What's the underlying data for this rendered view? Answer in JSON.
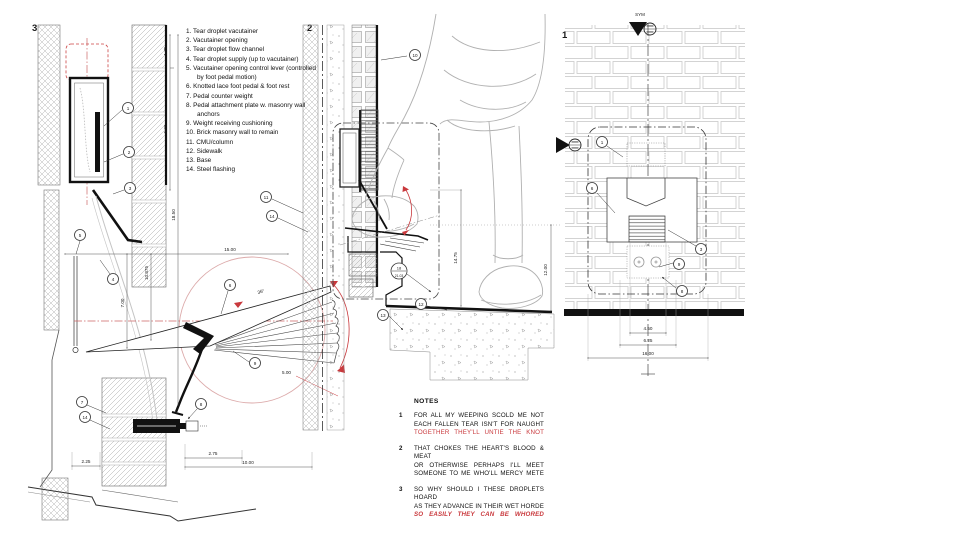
{
  "labels": {
    "detail3": "3",
    "detail2": "2",
    "detail1": "1",
    "sym": "SYM"
  },
  "legend": {
    "items": [
      {
        "num": "1.",
        "text": "Tear droplet vacutainer"
      },
      {
        "num": "2.",
        "text": "Vacutainer opening"
      },
      {
        "num": "3.",
        "text": "Tear droplet flow channel"
      },
      {
        "num": "4.",
        "text": "Tear droplet supply (up to vacutainer)"
      },
      {
        "num": "5.",
        "text": "Vacutainer opening control lever (controlled by foot pedal motion)"
      },
      {
        "num": "6.",
        "text": "Knotted lace foot pedal & foot rest"
      },
      {
        "num": "7.",
        "text": "Pedal counter weight"
      },
      {
        "num": "8.",
        "text": "Pedal attachment plate w. masonry wall anchors"
      },
      {
        "num": "9.",
        "text": "Weight receiving cushioning"
      },
      {
        "num": "10.",
        "text": "Brick masonry wall to remain"
      },
      {
        "num": "11.",
        "text": "CMU/column"
      },
      {
        "num": "12.",
        "text": "Sidewalk"
      },
      {
        "num": "13.",
        "text": "Base"
      },
      {
        "num": "14.",
        "text": "Steel flashing"
      }
    ]
  },
  "notes": {
    "title": "NOTES",
    "items": [
      {
        "num": "1",
        "lines": [
          "FOR ALL MY WEEPING SCOLD ME NOT",
          "EACH FALLEN TEAR ISN'T FOR NAUGHT",
          "TOGETHER THEY'LL UNTIE THE KNOT"
        ]
      },
      {
        "num": "2",
        "lines": [
          "THAT CHOKES THE HEART'S BLOOD & MEAT",
          "OR OTHERWISE PERHAPS I'LL MEET",
          "SOMEONE TO ME WHO'LL MERCY METE"
        ]
      },
      {
        "num": "3",
        "lines": [
          "SO WHY SHOULD I THESE DROPLETS HOARD",
          "AS THEY ADVANCE IN THEIR WET HORDE",
          "SO EASILY THEY CAN BE WHORED"
        ]
      }
    ]
  },
  "callouts": {
    "c1": "1",
    "c2": "2",
    "c3": "3",
    "c4": "4",
    "c5": "5",
    "c6": "6",
    "c7": "7",
    "c8": "8",
    "c9": "9",
    "c10": "10",
    "c11": "11",
    "c12": "12",
    "c13": "13",
    "c14": "14",
    "detail_ref": {
      "top": "18",
      "bottom": "21.03"
    }
  },
  "dims": {
    "h15": "15.00",
    "v175": "1.75",
    "v600": "6.00",
    "v1850": "18.50",
    "v10875": "10.875",
    "v700": "7.00",
    "b225": "2.25",
    "b275": "2.75",
    "b1000": "10.00",
    "r500": "5.00",
    "a36": "36°",
    "v1475": "14.75",
    "v1200": "12.00",
    "e450": "4.50",
    "e625": "6.25",
    "e1600": "16.00"
  },
  "colors": {
    "ink": "#1a1a1a",
    "red": "#c9393d",
    "pink": "#dcaaaa",
    "figure_gray": "#b0b0b0"
  }
}
